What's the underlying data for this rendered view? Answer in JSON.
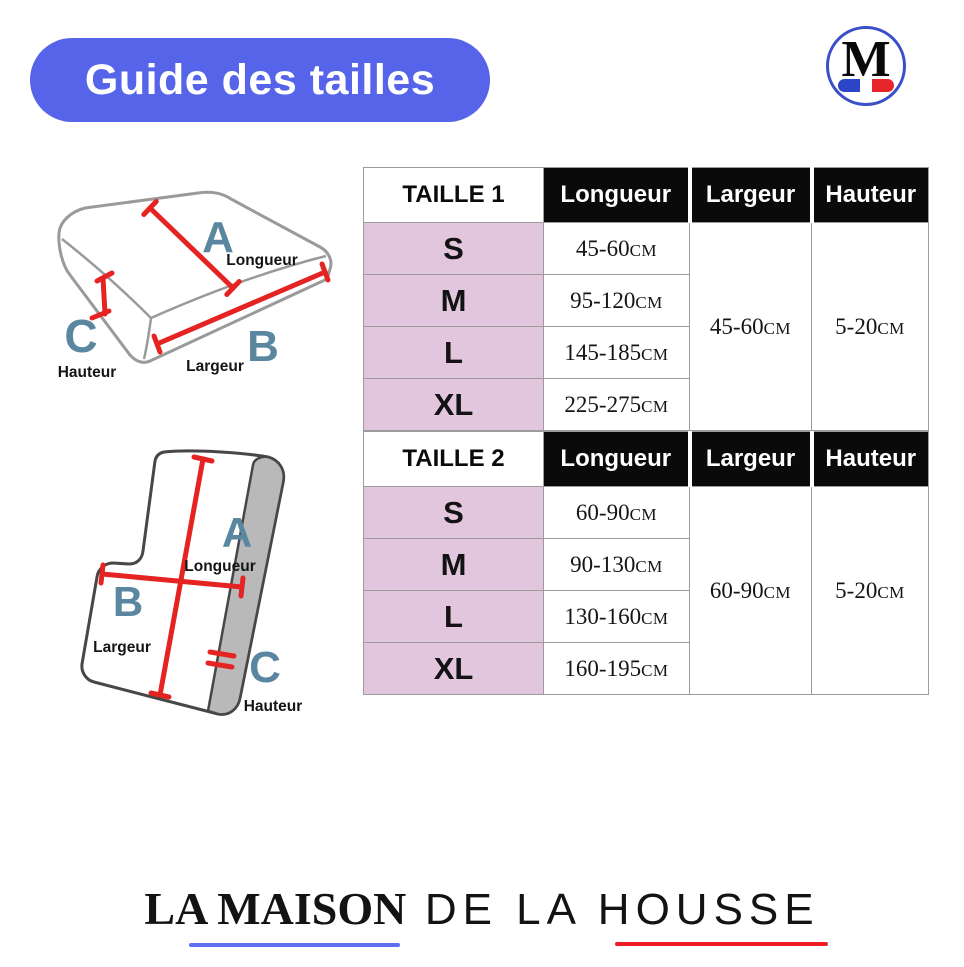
{
  "colors": {
    "page_bg": "#ffffff",
    "accent_blue": "#5564e8",
    "circle_blue": "#3a50c8",
    "flag_blue": "#2b45c8",
    "flag_red": "#e8242b",
    "header_black": "#0a0a0a",
    "table_pink": "#e1c6de",
    "arrow_red": "#e42322",
    "letter_slate": "#5a86a0",
    "underline_blue": "#5f6ff2",
    "underline_red": "#ec1c24"
  },
  "title_pill": {
    "label": "Guide des tailles"
  },
  "brand_badge": {
    "letter": "M"
  },
  "diagrams": {
    "rectangular_cushion": {
      "letter_a": "A",
      "letter_b": "B",
      "letter_c": "C",
      "label_longueur": "Longueur",
      "label_largeur": "Largeur",
      "label_hauteur": "Hauteur"
    },
    "lshape_cushion": {
      "letter_a": "A",
      "letter_b": "B",
      "letter_c": "C",
      "label_longueur": "Longueur",
      "label_largeur": "Largeur",
      "label_hauteur": "Hauteur"
    }
  },
  "tables": [
    {
      "name": "TAILLE 1",
      "headers": {
        "longueur": "Longueur",
        "largeur": "Largeur",
        "hauteur": "Hauteur"
      },
      "rows": [
        {
          "size": "S",
          "longueur": "45-60"
        },
        {
          "size": "M",
          "longueur": "95-120"
        },
        {
          "size": "L",
          "longueur": "145-185"
        },
        {
          "size": "XL",
          "longueur": "225-275"
        }
      ],
      "largeur": "45-60",
      "hauteur": "5-20",
      "unit": "CM"
    },
    {
      "name": "TAILLE 2",
      "headers": {
        "longueur": "Longueur",
        "largeur": "Largeur",
        "hauteur": "Hauteur"
      },
      "rows": [
        {
          "size": "S",
          "longueur": "60-90"
        },
        {
          "size": "M",
          "longueur": "90-130"
        },
        {
          "size": "L",
          "longueur": "130-160"
        },
        {
          "size": "XL",
          "longueur": "160-195"
        }
      ],
      "largeur": "60-90",
      "hauteur": "5-20",
      "unit": "CM"
    }
  ],
  "footer_logo": {
    "part_bold": "LA MAISON",
    "part_light": "DE LA HOUSSE"
  }
}
